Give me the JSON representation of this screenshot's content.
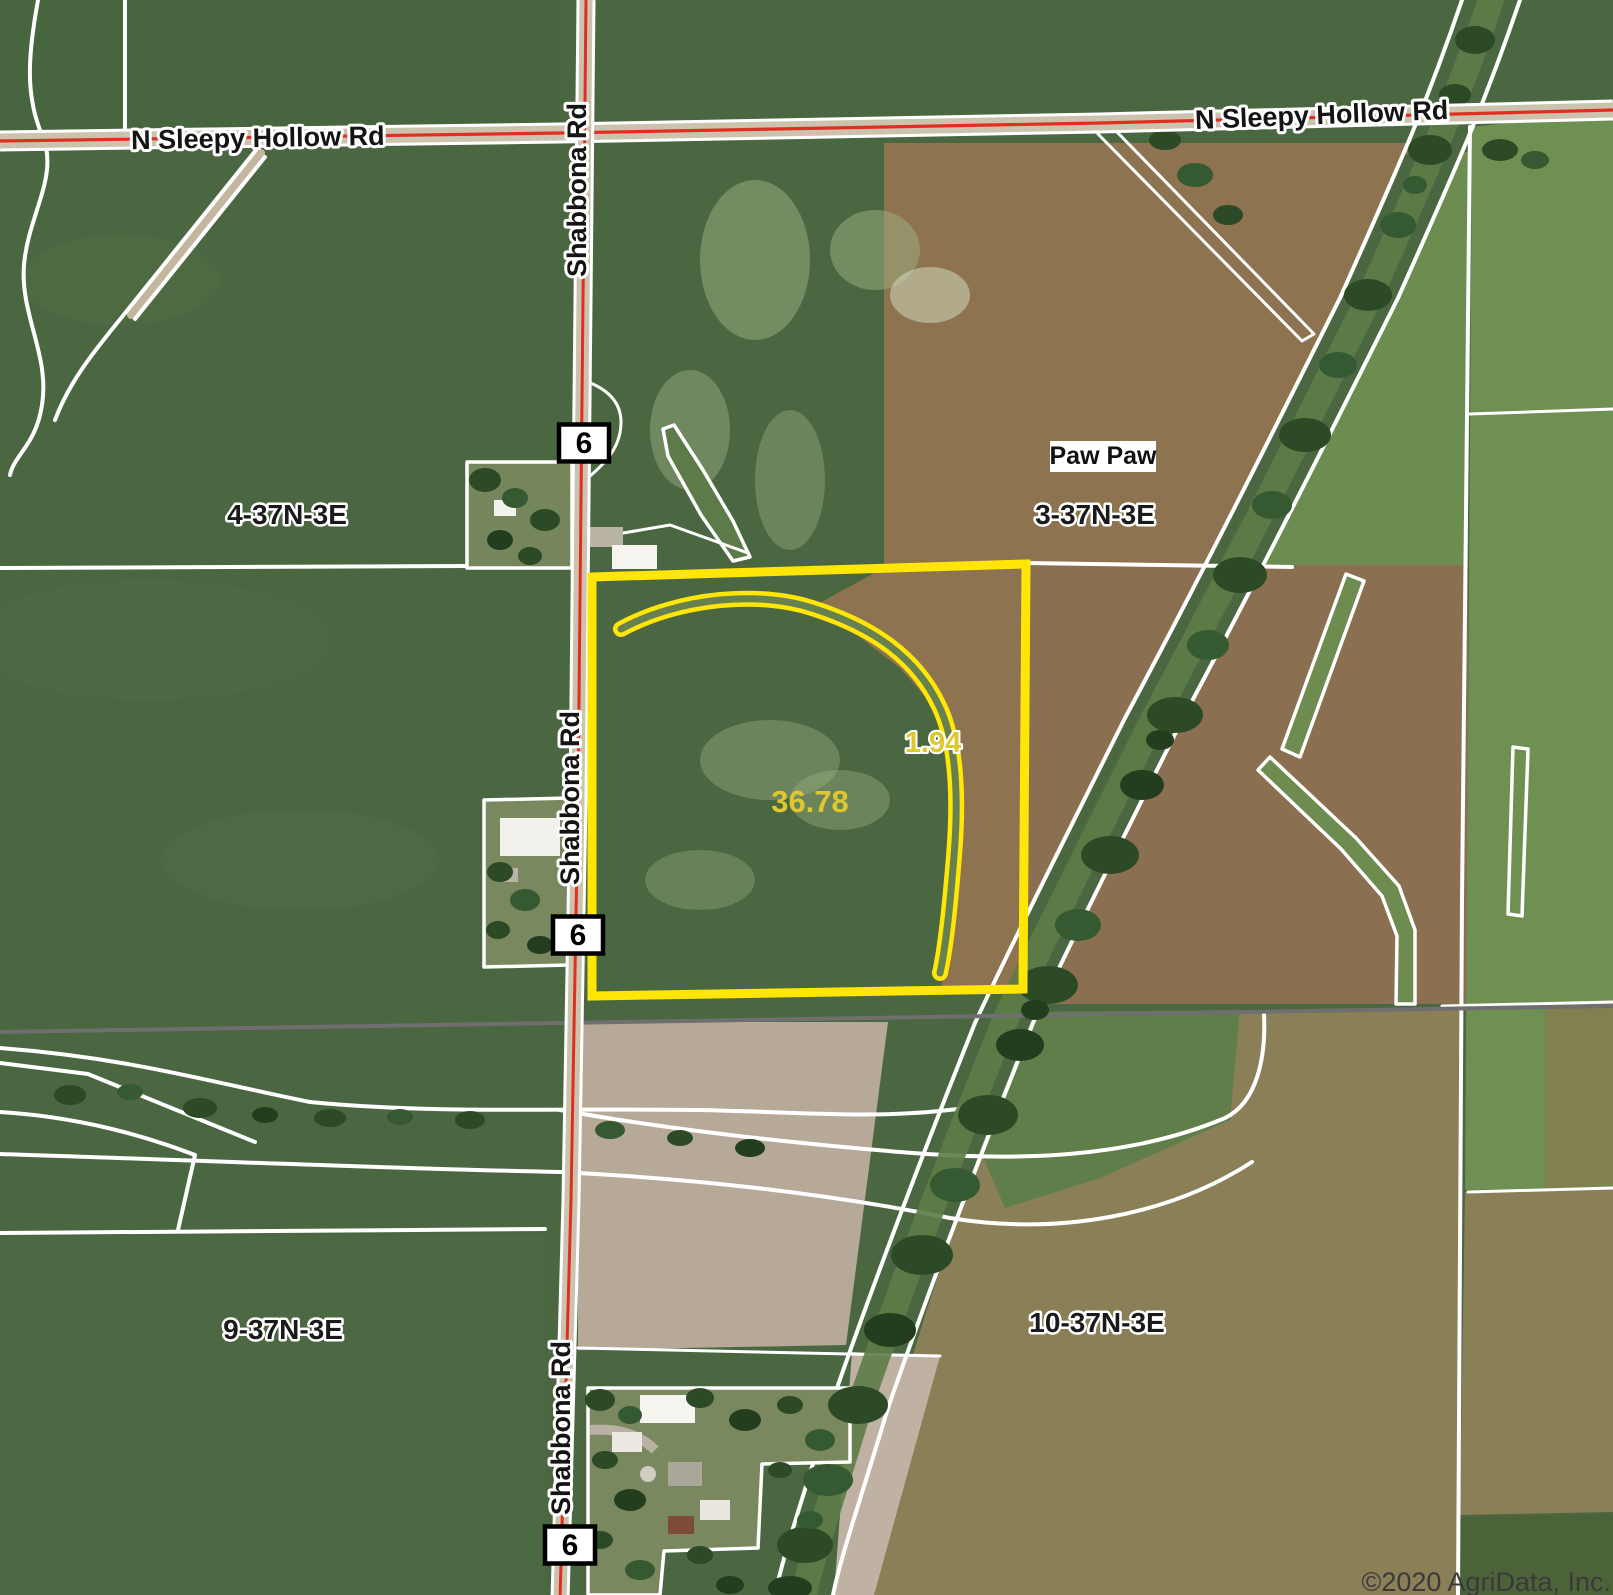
{
  "map": {
    "attribution": "©2020 AgriData, Inc.",
    "town": "Paw Paw",
    "route_shield": "6",
    "road_names": {
      "sleepy_hollow_w": "N Sleepy Hollow Rd",
      "sleepy_hollow_e": "N Sleepy Hollow Rd",
      "shabbona_n": "Shabbona Rd",
      "shabbona_mid": "Shabbona Rd",
      "shabbona_s": "Shabbona Rd"
    },
    "sections": {
      "nw": "4-37N-3E",
      "ne": "3-37N-3E",
      "sw": "9-37N-3E",
      "se": "10-37N-3E"
    },
    "parcel": {
      "main_acres": "36.78",
      "waterway_acres": "1.94"
    },
    "colors": {
      "parcel_outline": "#ffe606",
      "acreage_text": "#dfc72e",
      "road_centerline": "#df2f21",
      "boundary_lines": "#ffffff",
      "railroad_line": "#6f6f6f"
    }
  }
}
